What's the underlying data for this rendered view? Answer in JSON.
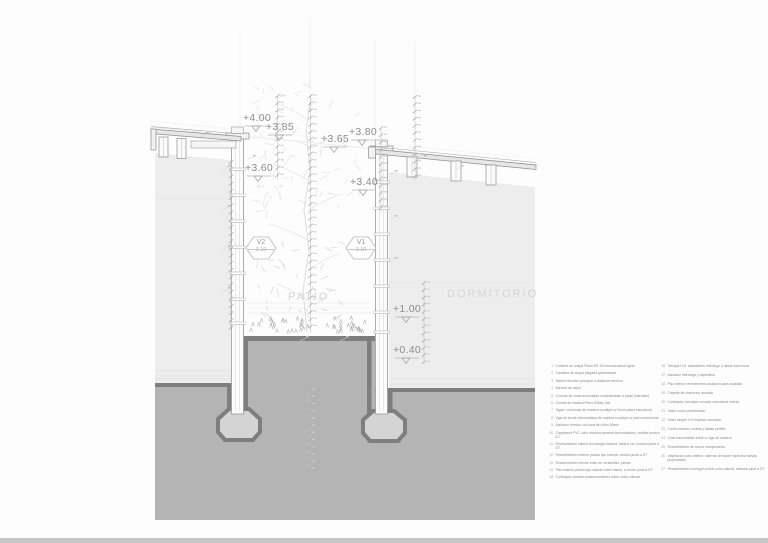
{
  "drawing": {
    "rooms": {
      "patio": "PATIO",
      "dormitorio": "DORMITORIO"
    },
    "levels": [
      {
        "label": "+4.00"
      },
      {
        "label": "+3.85"
      },
      {
        "label": "+3.80"
      },
      {
        "label": "+3.65"
      },
      {
        "label": "+3.60"
      },
      {
        "label": "+3.40"
      },
      {
        "label": "+1.00"
      },
      {
        "label": "+0.40"
      }
    ],
    "window_tags": [
      {
        "id": "V2",
        "value": "3.10"
      },
      {
        "id": "V1",
        "value": "3.10"
      }
    ]
  },
  "legend": {
    "left": [
      {
        "num": "1",
        "text": "Cubierta de chapa Panel KR-18 termoacustica rigida"
      },
      {
        "num": "2",
        "text": "Canaleta de chapa plegada galvanizada"
      },
      {
        "num": "3",
        "text": "Tablero fenolico principal c/ aislacion termica"
      },
      {
        "num": "4",
        "text": "Barrera de vapor"
      },
      {
        "num": "5",
        "text": "Correas de madera eucalipto suministradas a panel (laterales)"
      },
      {
        "num": "6",
        "text": "Cenefa de madera Pinus Elliotis 2x6"
      },
      {
        "num": "7",
        "text": "Vigas / columnas de madera eucalipto s/ North plano estructural"
      },
      {
        "num": "8",
        "text": "Viga de borde intermediaria de madera eucalipto s/ plano estructural"
      },
      {
        "num": "9",
        "text": "Aislacion termica con lana de vidrio 50mm"
      },
      {
        "num": "10",
        "text": "Carpinteria PVC color madera paneles desmontables, ventilar junta a DT"
      },
      {
        "num": "11",
        "text": "Revestimiento interior tecnologia madera, tabla a ver, modulo junta a DT"
      },
      {
        "num": "12",
        "text": "Revestimiento exterior placas tipo natural, modulo junta a DT"
      },
      {
        "num": "13",
        "text": "Recubrimiento interior tratto de ventanillas, piezas"
      },
      {
        "num": "14",
        "text": "Piso exterior piedra laja natural sobre manto, a contar junta a DT"
      },
      {
        "num": "15",
        "text": "Contrapiso armado estacionamiento sobre suelo natural"
      }
    ],
    "right": [
      {
        "num": "16",
        "text": "Tabique H.A. aislamiento hidrofugo y tablas estructura"
      },
      {
        "num": "17",
        "text": "Aislacion hidrofuga y especifica"
      },
      {
        "num": "18",
        "text": "Piso interior revestimiento aislacion para acabado"
      },
      {
        "num": "19",
        "text": "Carpeta de nivelacion armada"
      },
      {
        "num": "20",
        "text": "Contrapiso hormigon armado estructural interior"
      },
      {
        "num": "21",
        "text": "Vidrio crudo prefabricado"
      },
      {
        "num": "22",
        "text": "Vidrio simple 4+4 espesor laminado"
      },
      {
        "num": "23",
        "text": "Canto metalico umbral y tablas perfiles"
      },
      {
        "num": "24",
        "text": "Cinta transmisible doble c/ viga de madera"
      },
      {
        "num": "25",
        "text": "Revestimiento de muros mamposteria"
      },
      {
        "num": "26",
        "text": "Vegetacion para interior, sistema drenante especies nativas proyectadas"
      },
      {
        "num": "27",
        "text": "Recubrimiento hormigon pulido color natural, articular junta a DT"
      }
    ]
  },
  "colors": {
    "ground": "#b4b4b4",
    "ground_dark": "#7e7e7e",
    "room_fill": "#ededed",
    "footing_fill": "#d4d4d4",
    "linework": "#8f8f8f",
    "label_text": "#8c8c8c",
    "room_text": "#d5d5d5"
  }
}
